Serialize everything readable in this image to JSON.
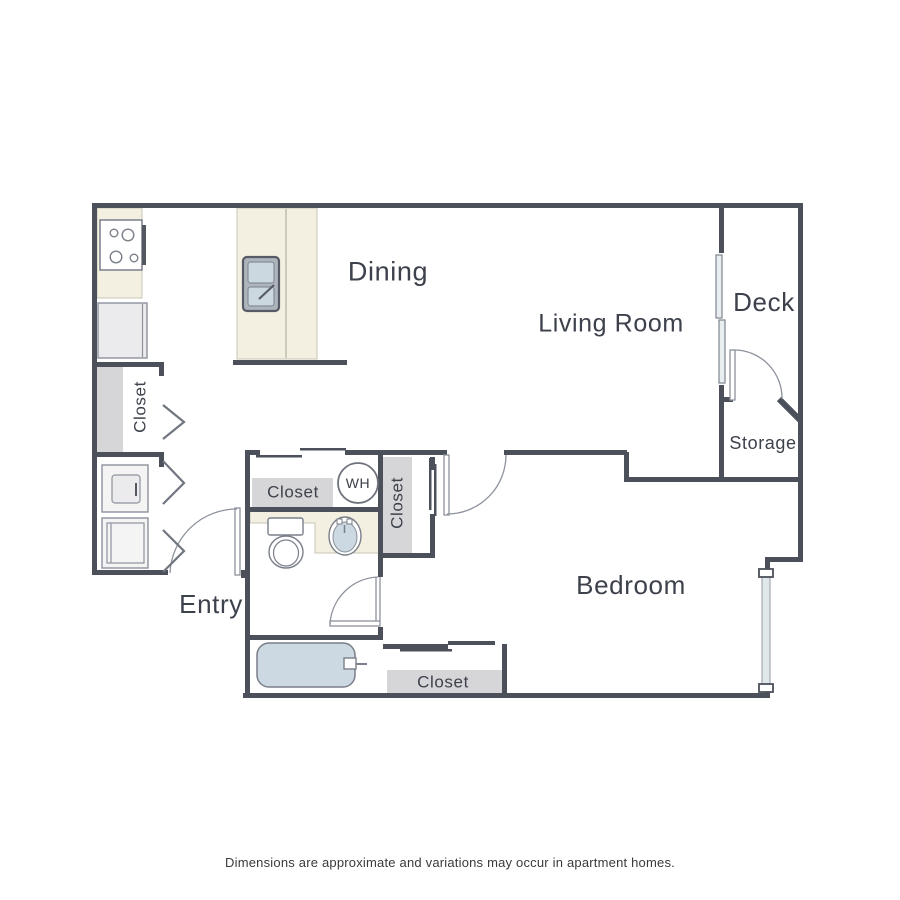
{
  "rooms": {
    "dining": "Dining",
    "living_room": "Living Room",
    "deck": "Deck",
    "storage": "Storage",
    "bedroom": "Bedroom",
    "entry": "Entry"
  },
  "labels": {
    "water_heater": "WH",
    "closet_kitchen": "Closet",
    "closet_bath": "Closet",
    "closet_hall": "Closet",
    "closet_bedroom": "Closet"
  },
  "footer": {
    "disclaimer": "Dimensions are approximate and variations may occur in apartment homes."
  },
  "colors": {
    "wall": "#4b505a",
    "counter": "#f3f0e1",
    "closet": "#d6d6d8",
    "fixture_blue": "#cdd9e2",
    "window_glass": "#dfe9eb",
    "appliance": "#ebebed",
    "line": "#7a7f89",
    "door_line": "#8d929c",
    "text": "#3d414b"
  }
}
